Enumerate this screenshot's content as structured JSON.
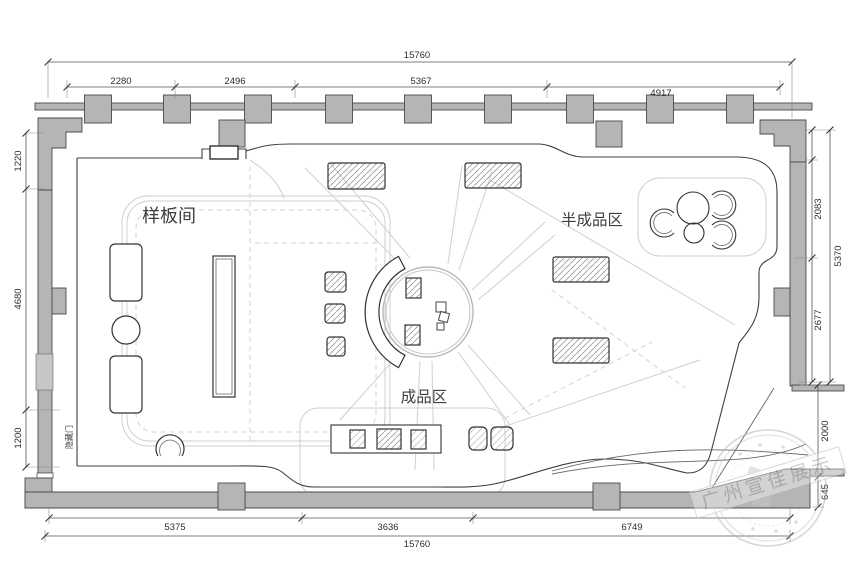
{
  "plan": {
    "areas": {
      "sample_room": "样板间",
      "semi_finished_zone": "半成品区",
      "finished_zone": "成品区",
      "hidden_door": "隐藏门"
    },
    "dimensions": {
      "top": {
        "overall": "15760",
        "seg1": "2280",
        "seg2": "2496",
        "seg3": "5367",
        "seg4": "4917"
      },
      "left": {
        "seg1": "1220",
        "seg2": "4680",
        "seg3": "1200"
      },
      "right": {
        "overall": "5370",
        "seg1": "2083",
        "seg2": "2677",
        "seg3": "2000",
        "seg4": "645"
      },
      "bottom": {
        "overall": "15760",
        "seg1": "5375",
        "seg2": "3636",
        "seg3": "6749"
      }
    },
    "watermark": {
      "text": "广州宣佳展示"
    },
    "colors": {
      "wall_fill": "#b5b5b5",
      "line": "#3f3f3f",
      "pattern": "#cfcfcf",
      "dim_text": "#2e2e2e",
      "watermark": "#b0b0b0"
    }
  }
}
